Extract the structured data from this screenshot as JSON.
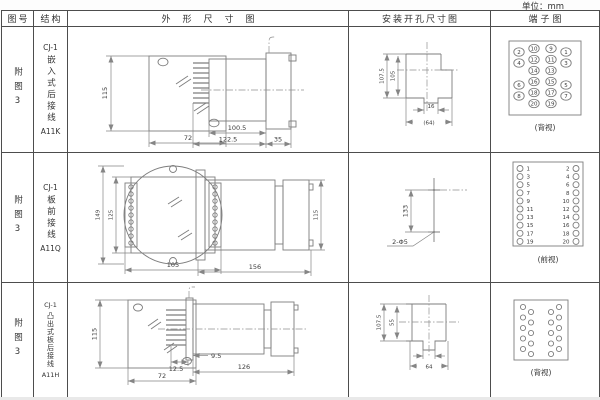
{
  "unit_label": "单位：mm",
  "header": {
    "fig_no": "图号",
    "structure": "结构",
    "outline": "外形尺寸图",
    "install": "安装开孔尺寸图",
    "terminal": "端子图"
  },
  "rows": [
    {
      "fig_no": "附图3",
      "structure": {
        "code": "CJ-1",
        "name": "嵌入式后接线",
        "model": "A11K"
      },
      "outline_dims": {
        "front_height": "115",
        "front_width": "72",
        "body_length": "100.5",
        "total_length": "122.5",
        "flange_depth": "35"
      },
      "install_dims": {
        "height_outer": "107.5",
        "height_inner": "105",
        "notch_width": "16",
        "cutout_width": "(64)"
      },
      "terminal": {
        "view_label": "(背视)",
        "outer_left": [
          "2",
          "4",
          "6",
          "8"
        ],
        "inner_left": [
          "10",
          "12",
          "14",
          "16",
          "18",
          "20"
        ],
        "inner_right": [
          "9",
          "11",
          "13",
          "15",
          "17",
          "19"
        ],
        "outer_right": [
          "1",
          "3",
          "5",
          "7"
        ]
      }
    },
    {
      "fig_no": "附图3",
      "structure": {
        "code": "CJ-1",
        "name": "板前接线",
        "model": "A11Q"
      },
      "outline_dims": {
        "front_height_outer": "149",
        "front_height_inner": "125",
        "front_width": "105",
        "total_length": "156",
        "body_height": "115"
      },
      "install_dims": {
        "hole_spacing": "133",
        "holes": "2-Φ5"
      },
      "terminal": {
        "view_label": "(前视)",
        "left": [
          "1",
          "3",
          "5",
          "7",
          "9",
          "11",
          "13",
          "15",
          "17",
          "19"
        ],
        "right": [
          "2",
          "4",
          "6",
          "8",
          "10",
          "12",
          "14",
          "16",
          "18",
          "20"
        ]
      }
    },
    {
      "fig_no": "附图3",
      "structure": {
        "code": "CJ-1",
        "name": "凸出式板后接线",
        "model": "A11H"
      },
      "outline_dims": {
        "front_height": "115",
        "front_width": "72",
        "pin_length": "12.5",
        "offset": "9.5",
        "total_length": "126"
      },
      "install_dims": {
        "height_outer": "107.5",
        "height_inner": "55",
        "cutout_width": "64"
      },
      "terminal": {
        "view_label": "(背视)"
      }
    }
  ]
}
